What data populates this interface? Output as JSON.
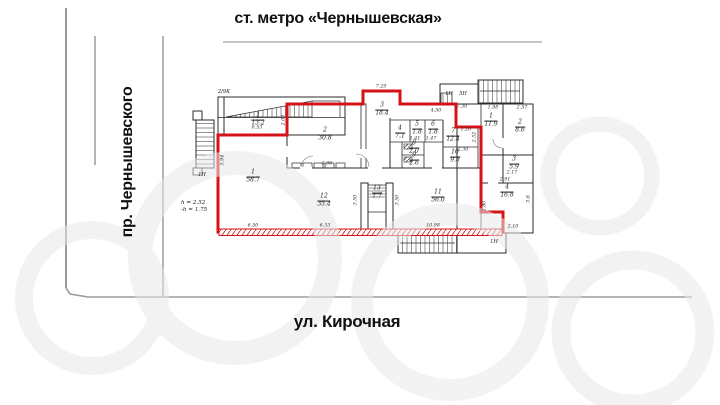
{
  "labels": {
    "metro": "ст. метро «Чернышевская»",
    "street_left": "пр. Чернышевского",
    "street_bottom": "ул. Кирочная"
  },
  "plan": {
    "building_note": "2/9К",
    "height_note_1": "h = 2.52",
    "height_note_2": "-h = 1.75",
    "rooms": [
      {
        "num": "1",
        "area": "13.2"
      },
      {
        "num": "1",
        "area": "58.7"
      },
      {
        "num": "2",
        "area": "30.8"
      },
      {
        "num": "3",
        "area": "18.4"
      },
      {
        "num": "4",
        "area": "7.1"
      },
      {
        "num": "5",
        "area": "1.8"
      },
      {
        "num": "6",
        "area": "1.8"
      },
      {
        "num": "7",
        "area": "12.4"
      },
      {
        "num": "8",
        "area": "2.0"
      },
      {
        "num": "9",
        "area": "2.6"
      },
      {
        "num": "10",
        "area": "9.8"
      },
      {
        "num": "11",
        "area": "56.0"
      },
      {
        "num": "12",
        "area": "35.4"
      },
      {
        "num": "13",
        "area": "1.7"
      },
      {
        "num": "1",
        "area": "11.9"
      },
      {
        "num": "2",
        "area": "8.6"
      },
      {
        "num": "3",
        "area": "5.9"
      },
      {
        "num": "4",
        "area": "16.8"
      }
    ],
    "dims": [
      {
        "text": "6.53"
      },
      {
        "text": "2.00"
      },
      {
        "text": "7.29"
      },
      {
        "text": "4.50"
      },
      {
        "text": "7.30"
      },
      {
        "text": "1.98"
      },
      {
        "text": "2.57"
      },
      {
        "text": "1.20"
      },
      {
        "text": "2.30"
      },
      {
        "text": "1.41"
      },
      {
        "text": "1.47"
      },
      {
        "text": "2.17"
      },
      {
        "text": "2.91"
      },
      {
        "text": "3.8"
      },
      {
        "text": "2.10"
      },
      {
        "text": "1.80"
      },
      {
        "text": "6.50"
      },
      {
        "text": "6.33"
      },
      {
        "text": "10.98"
      },
      {
        "text": "3.50"
      },
      {
        "text": "3.50"
      },
      {
        "text": "5.94"
      },
      {
        "text": "3.96"
      },
      {
        "text": "2.52"
      }
    ],
    "stairs": [
      {
        "label": "1Н"
      },
      {
        "label": "1Н"
      },
      {
        "label": "5Н"
      },
      {
        "label": "1Н"
      }
    ]
  },
  "colors": {
    "premises_outline": "#d41217",
    "walls": "#2b2b2b",
    "street_lines": "#9b9b9b",
    "text": "#111111"
  }
}
